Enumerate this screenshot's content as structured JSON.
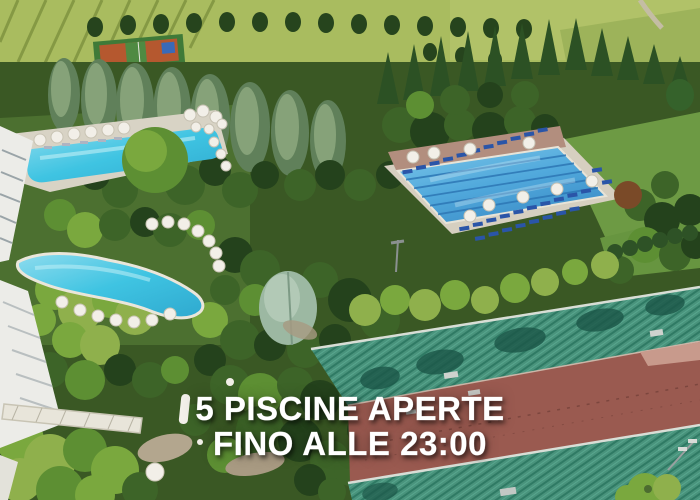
{
  "overlay": {
    "line1": "5 PISCINE APERTE",
    "line2": "FINO ALLE 23:00"
  },
  "palette": {
    "pool_water": "#3fc4e2",
    "pool_water_light": "#9fe2ef",
    "lap_pool_water": "#51a9dc",
    "lane_line": "#2d77b5",
    "deck_stone": "#d8d3c5",
    "deck_terracotta": "#b28e7e",
    "ground_red": "#9a5a50",
    "roof_green": "#49937c",
    "roof_green_shadow": "#1c5748",
    "tree_dark": "#24421c",
    "tree_mid": "#3d6428",
    "tree_bright": "#5d8f33",
    "tree_light": "#7aa83e",
    "tree_yellow": "#8fb04c",
    "tree_silver": "#9cb8a2",
    "field_green": "#a9bc5f",
    "building_white": "#ecece8",
    "umbrella_white": "#f2efe8",
    "lounger_blue": "#2a55a8",
    "text_white": "#ffffff"
  }
}
